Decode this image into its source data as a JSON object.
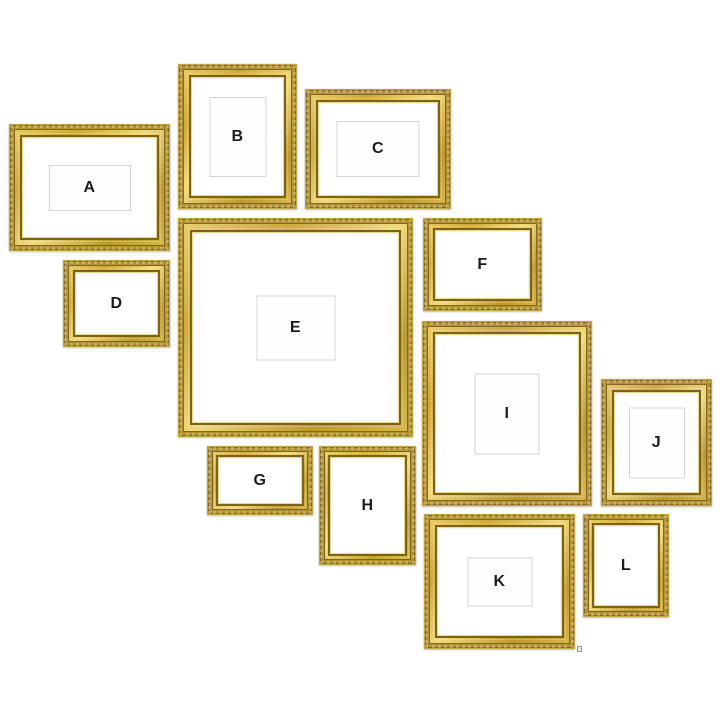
{
  "page": {
    "background": "#ffffff",
    "description": "Gallery wall layout diagram of twelve ornate gold picture frames labeled A through L"
  },
  "palette": {
    "frame_gold_bright": "#f0d97e",
    "frame_gold_mid": "#cfa93b",
    "frame_gold_dark": "#83671a",
    "frame_lip_pale": "#ead98f",
    "mat_white": "#ffffff",
    "opening_border": "#d6d6d6",
    "letter_color": "#1c1c1c",
    "watermark_gray": "#9a9a9a"
  },
  "watermark": {
    "icon": "tiny-gray-mark"
  },
  "frames": [
    {
      "label": "A",
      "x": 9,
      "y": 124,
      "w": 161,
      "h": 127,
      "molding": 14,
      "opening": {
        "w": 80,
        "h": 44
      }
    },
    {
      "label": "B",
      "x": 178,
      "y": 64,
      "w": 119,
      "h": 145,
      "molding": 14,
      "opening": {
        "w": 55,
        "h": 78
      }
    },
    {
      "label": "C",
      "x": 305,
      "y": 89,
      "w": 146,
      "h": 120,
      "molding": 14,
      "opening": {
        "w": 81,
        "h": 54
      }
    },
    {
      "label": "D",
      "x": 63,
      "y": 260,
      "w": 107,
      "h": 87,
      "molding": 13,
      "opening": null
    },
    {
      "label": "E",
      "x": 178,
      "y": 218,
      "w": 235,
      "h": 219,
      "molding": 15,
      "opening": {
        "w": 77,
        "h": 63
      }
    },
    {
      "label": "F",
      "x": 423,
      "y": 218,
      "w": 119,
      "h": 93,
      "molding": 13,
      "opening": null
    },
    {
      "label": "G",
      "x": 207,
      "y": 446,
      "w": 106,
      "h": 69,
      "molding": 12,
      "opening": null
    },
    {
      "label": "H",
      "x": 319,
      "y": 446,
      "w": 97,
      "h": 119,
      "molding": 12,
      "opening": null
    },
    {
      "label": "I",
      "x": 422,
      "y": 321,
      "w": 170,
      "h": 185,
      "molding": 14,
      "opening": {
        "w": 63,
        "h": 79
      }
    },
    {
      "label": "J",
      "x": 601,
      "y": 379,
      "w": 111,
      "h": 127,
      "molding": 14,
      "opening": {
        "w": 54,
        "h": 69
      }
    },
    {
      "label": "K",
      "x": 424,
      "y": 514,
      "w": 151,
      "h": 135,
      "molding": 14,
      "opening": {
        "w": 63,
        "h": 47
      }
    },
    {
      "label": "L",
      "x": 583,
      "y": 514,
      "w": 86,
      "h": 103,
      "molding": 12,
      "opening": null
    }
  ]
}
